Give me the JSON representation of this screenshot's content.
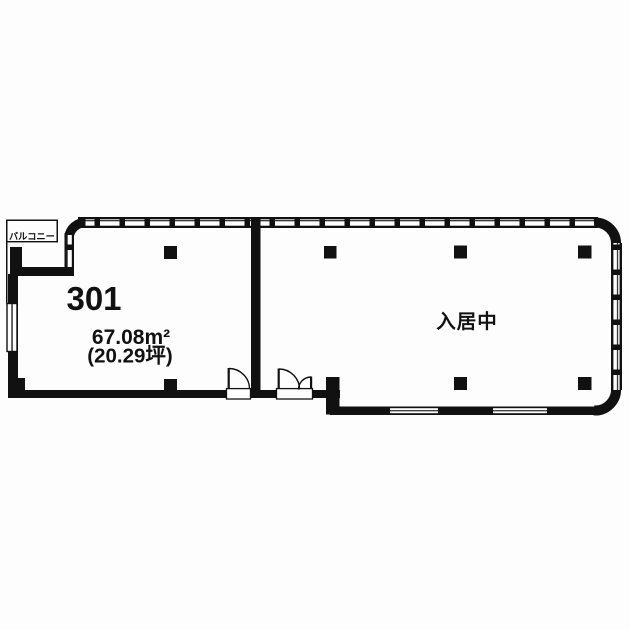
{
  "floor_plan": {
    "balcony": {
      "label": "バルコニー"
    },
    "unit_301": {
      "number": "301",
      "area_sqm": "67.08m²",
      "area_tsubo": "(20.29坪)"
    },
    "adjacent_unit": {
      "status": "入居中"
    },
    "colors": {
      "wall": "#111111",
      "background": "#fdfdfd",
      "window_glass": "#ffffff"
    }
  }
}
